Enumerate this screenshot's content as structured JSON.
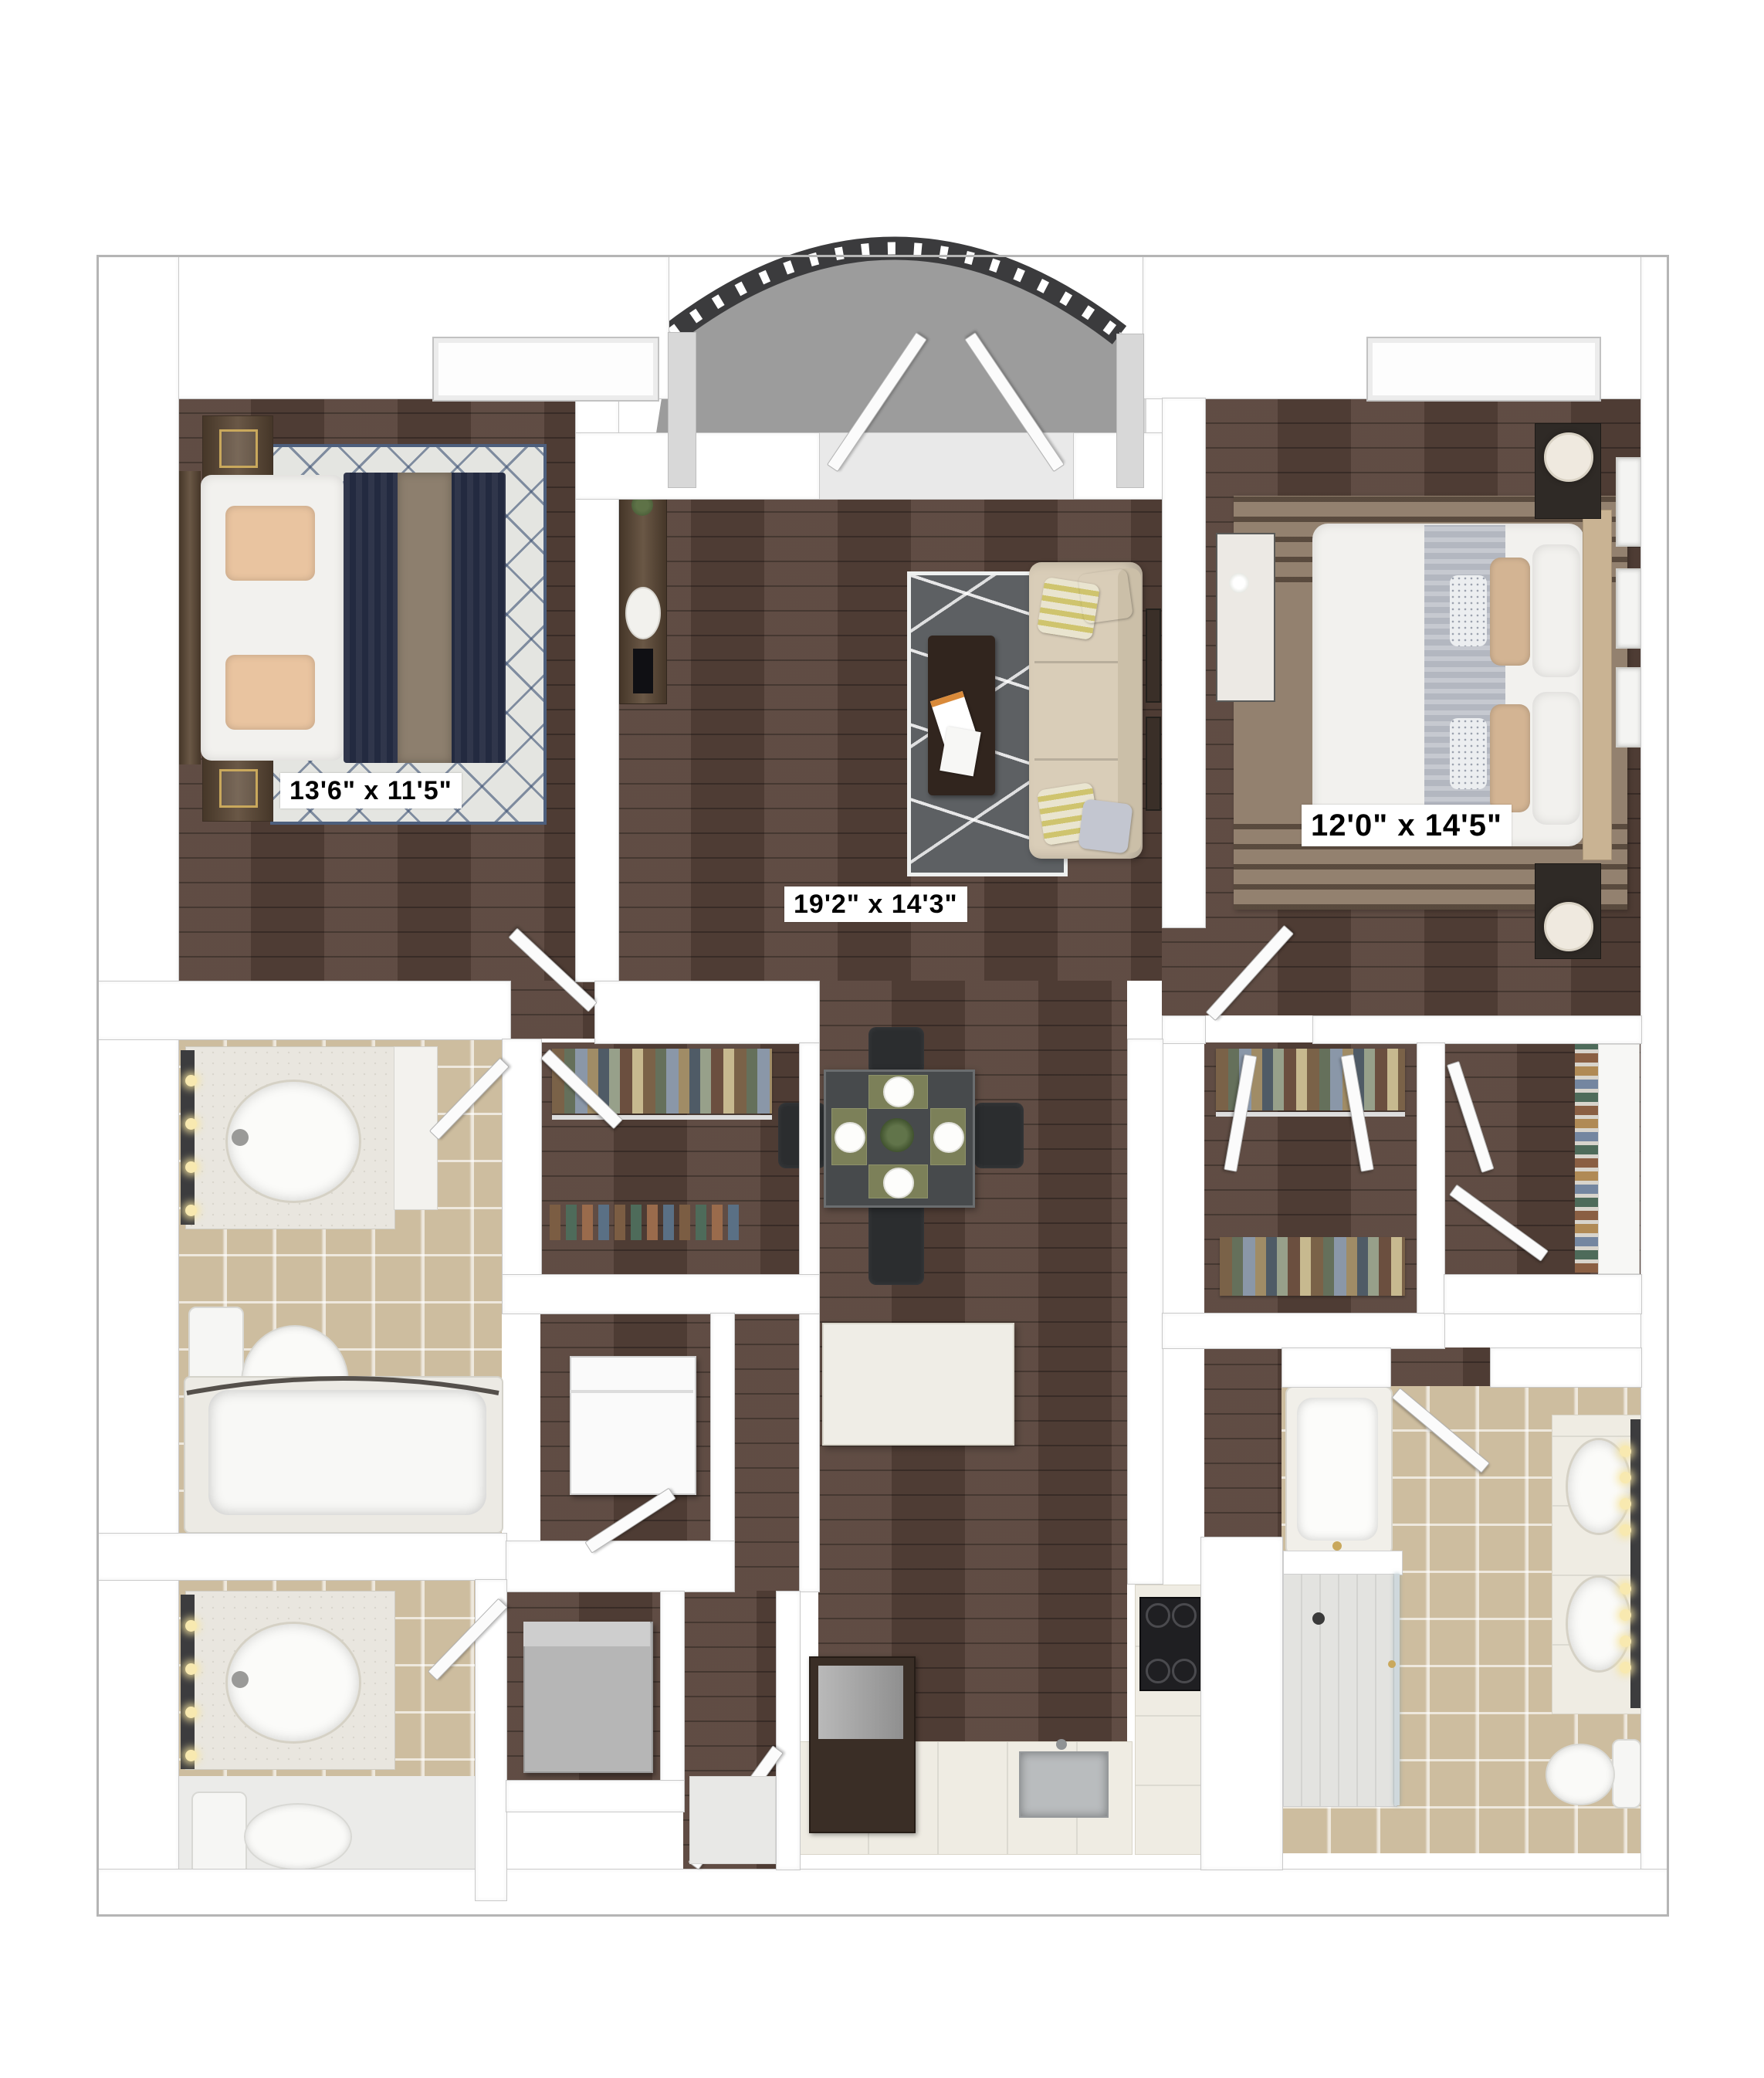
{
  "plan": {
    "type": "3d-floor-plan",
    "rooms": [
      {
        "name": "bedroom-1",
        "dimensions": "13'6\" x 11'5\""
      },
      {
        "name": "living-room",
        "dimensions": "19'2\" x 14'3\""
      },
      {
        "name": "bedroom-2",
        "dimensions": "12'0\" x 14'5\""
      }
    ]
  },
  "colors": {
    "wood": "#57433a",
    "tile": "#cdbd9f",
    "balcony_floor": "#9c9c9c",
    "railing": "#3b3b3d",
    "sofa": "#d9cdb8",
    "navy_bedding": "#232a40",
    "label_bg": "#ffffff",
    "label_text": "#000000"
  }
}
